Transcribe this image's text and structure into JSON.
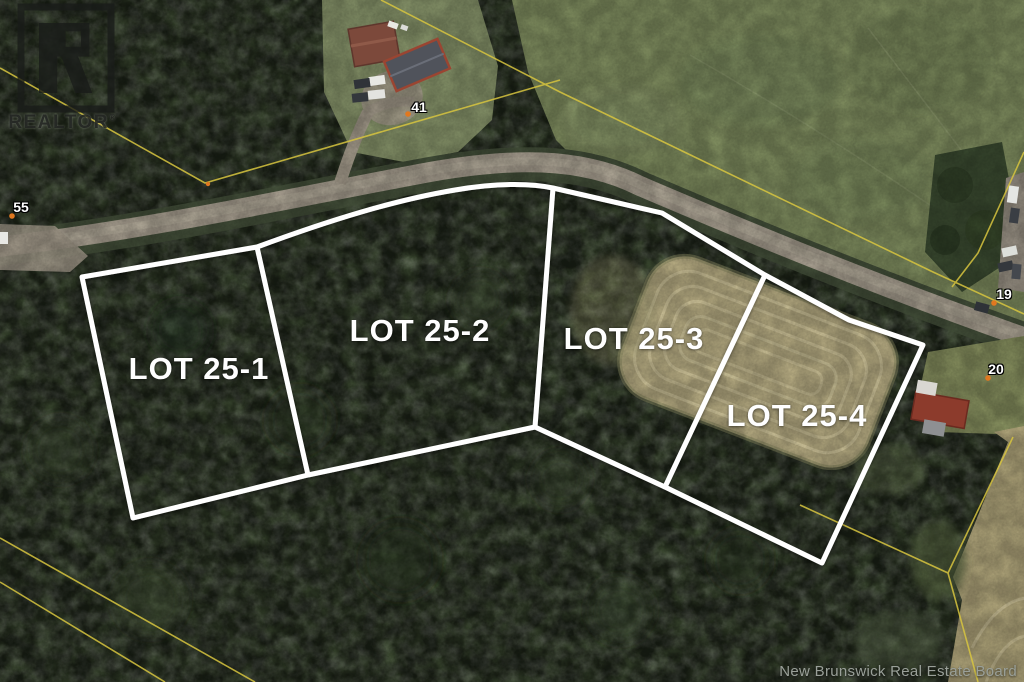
{
  "branding": {
    "realtor_text": "REALTOR",
    "registered_symbol": "®"
  },
  "lots": [
    {
      "id": "25-1",
      "label": "LOT 25-1"
    },
    {
      "id": "25-2",
      "label": "LOT 25-2"
    },
    {
      "id": "25-3",
      "label": "LOT 25-3"
    },
    {
      "id": "25-4",
      "label": "LOT 25-4"
    }
  ],
  "civic_numbers": [
    {
      "label": "55"
    },
    {
      "label": "41"
    },
    {
      "label": "19"
    },
    {
      "label": "20"
    }
  ],
  "attribution": {
    "text": "New Brunswick Real Estate Board"
  },
  "map": {
    "type": "aerial-photo-with-lot-overlay",
    "boundary_color": "#ffffff",
    "property_line_color": "#d8c53f",
    "survey_marker_color": "#e07820",
    "road_color": "#a9a091",
    "hay_field_color": "#b9ae84",
    "forest_color": "#3c4a31",
    "meadow_color": "#7f8d5f"
  }
}
